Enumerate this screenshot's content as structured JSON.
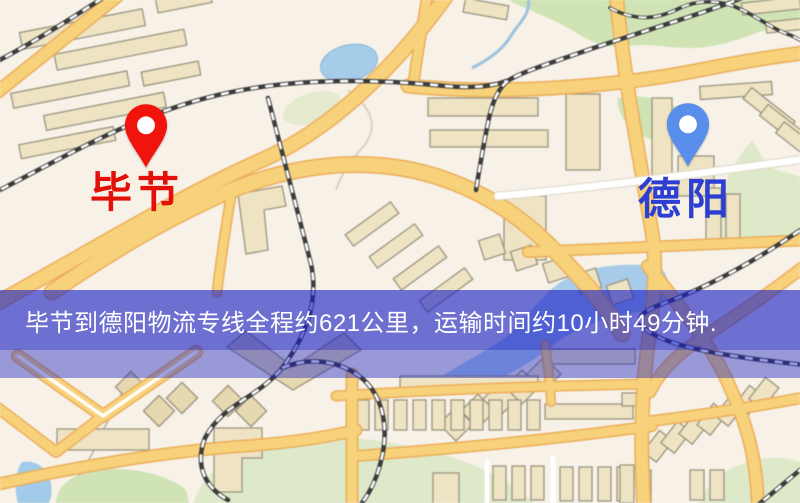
{
  "pins": {
    "origin": {
      "label": "毕节",
      "color": "#f0140c",
      "label_color": "#e31009"
    },
    "destination": {
      "label": "德阳",
      "color": "#5a8eeb",
      "label_color": "#2d3ed2"
    }
  },
  "banner": {
    "text": "毕节到德阳物流专线全程约621公里，运输时间约10小时49分钟.",
    "text_color": "#ffffff",
    "band_color": "rgba(25,30,195,0.62)",
    "band_secondary_color": "rgba(25,30,195,0.42)"
  },
  "route": {
    "origin": "毕节",
    "destination": "德阳",
    "distance_km": 621,
    "duration_hours": 10,
    "duration_minutes": 49
  }
}
